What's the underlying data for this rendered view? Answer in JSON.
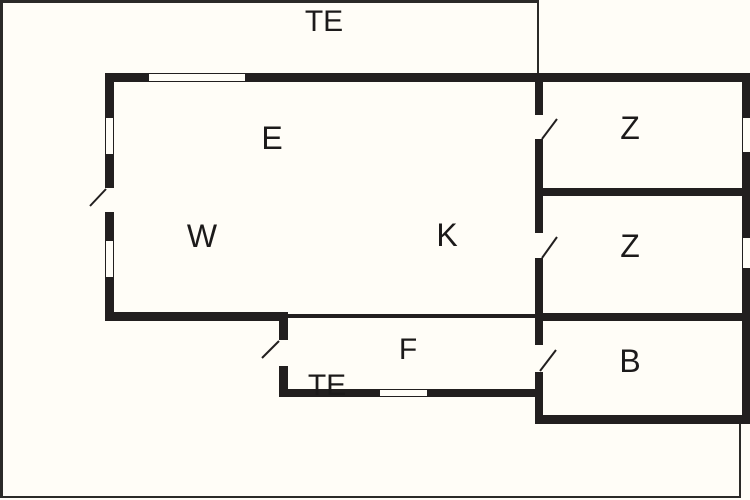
{
  "floorplan": {
    "rooms": [
      {
        "id": "terrace-top",
        "label": "TE"
      },
      {
        "id": "entry",
        "label": "E"
      },
      {
        "id": "living-room",
        "label": "W"
      },
      {
        "id": "kitchen",
        "label": "K"
      },
      {
        "id": "bedroom-1",
        "label": "Z"
      },
      {
        "id": "bedroom-2",
        "label": "Z"
      },
      {
        "id": "bathroom",
        "label": "B"
      },
      {
        "id": "hallway",
        "label": "F"
      },
      {
        "id": "terrace-bottom",
        "label": "TE"
      }
    ],
    "colors": {
      "wall": "#221f1f",
      "outline": "#2b2a28",
      "background": "#fffdf7",
      "text": "#1c1a1a"
    }
  }
}
